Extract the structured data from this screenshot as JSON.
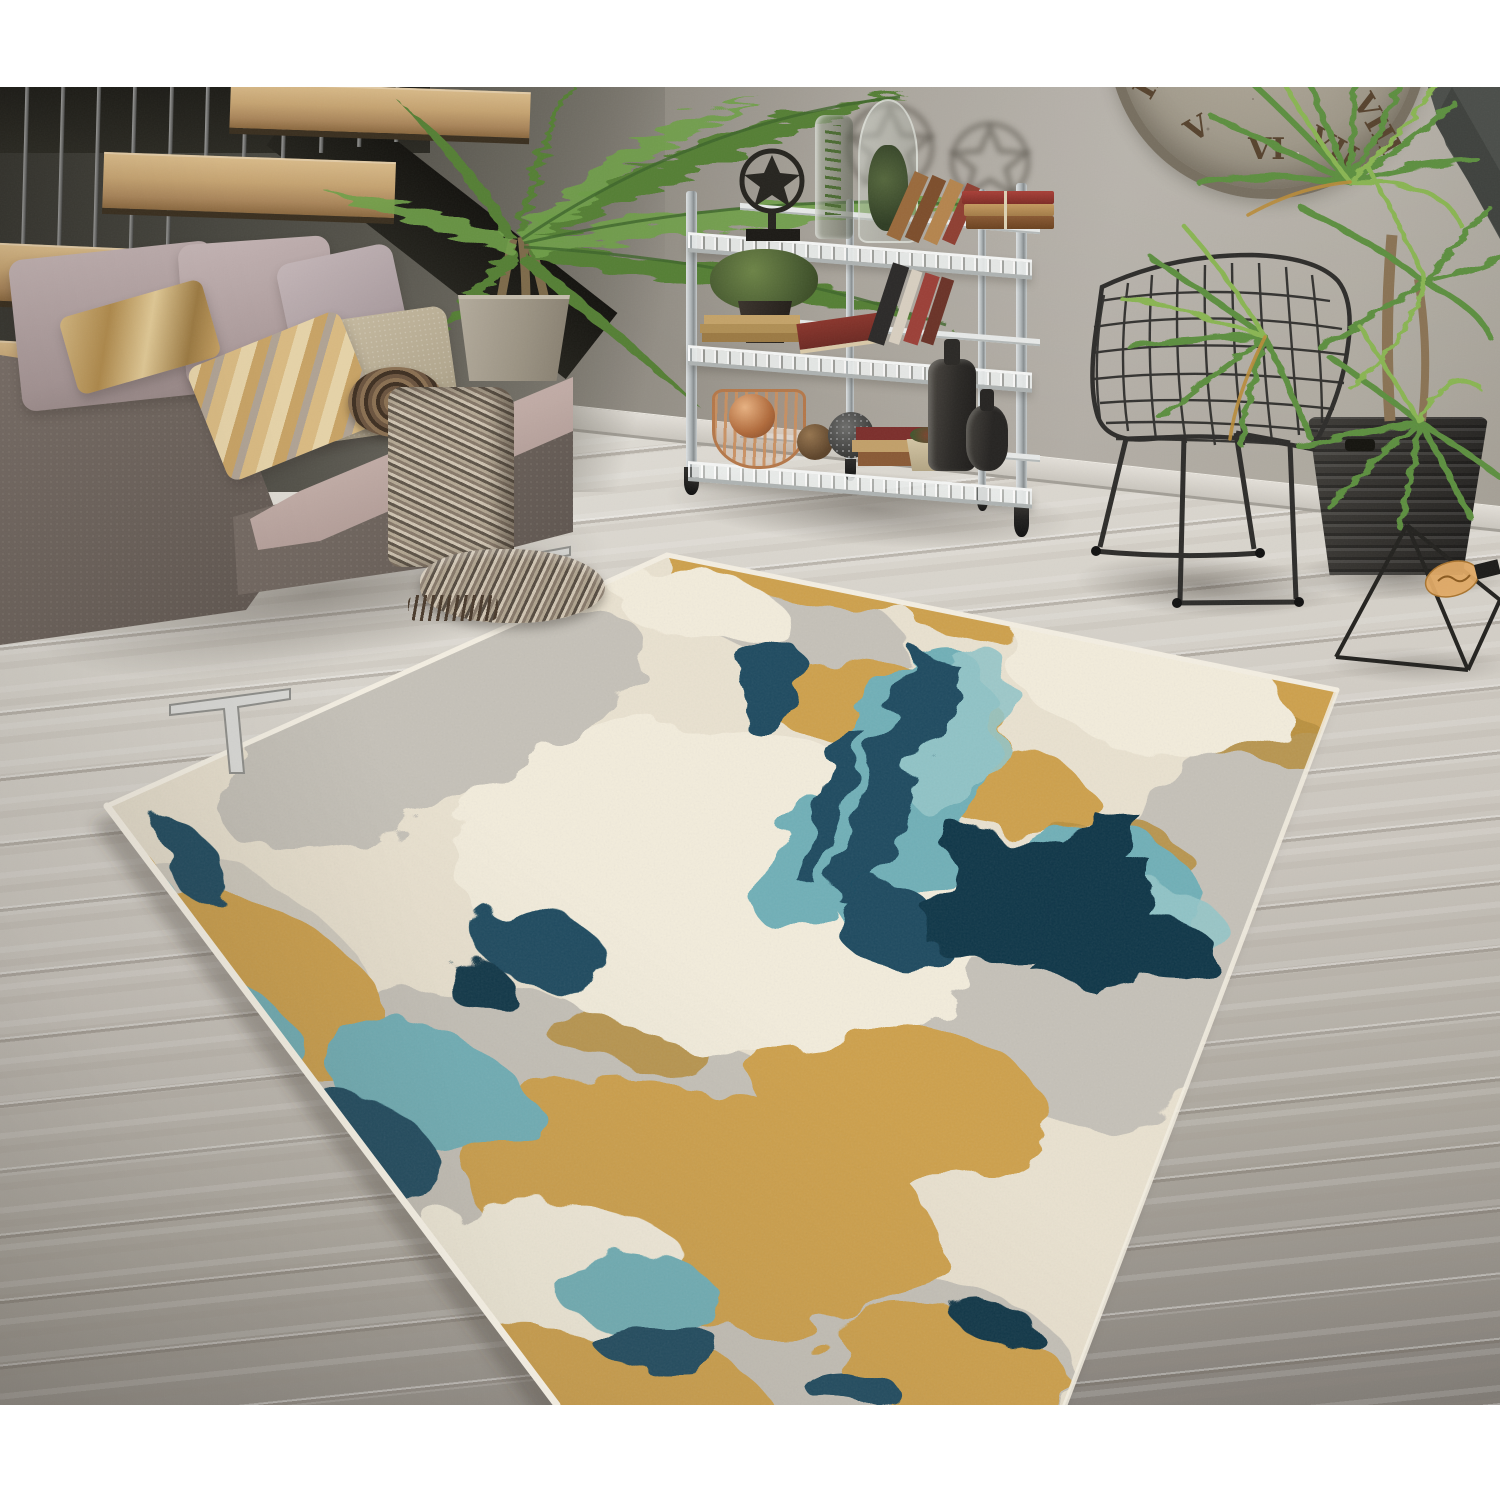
{
  "meta": {
    "image_kind": "lifestyle product photograph",
    "subject": "abstract distressed area rug styled in a modern loft living room",
    "visible_text": "none (only clock Roman numerals)"
  },
  "clock": {
    "numerals": [
      "IIII",
      "V",
      "VI",
      "VII",
      "VIII"
    ]
  },
  "palette": {
    "wall": "#a6a198",
    "wall_dark": "#4a4842",
    "baseboard": "#d9d5ce",
    "floor_light": "#dcd8d1",
    "floor_dark": "#837e78",
    "stair_wood": "#c5a371",
    "stair_metal": "#8c8c8a",
    "stair_beam": "#1a1914",
    "sofa_frame": "#6e645d",
    "sofa_seat": "#c0aba5",
    "pillow_mauve": "#b2a2a2",
    "pillow_lilac": "#b7a9ab",
    "pillow_beige": "#bdb29a",
    "pillow_gold": "#c29d5e",
    "throw": "#8d8274",
    "shelf_metal": "#c3c8c9",
    "copper": "#c08055",
    "book_red": "#9e3b32",
    "book_tan": "#b98e58",
    "book_brown": "#7d4e2c",
    "book_dark": "#2c2a29",
    "palm_green": "#547f36",
    "palm_green_light": "#6fa04a",
    "palm_stem": "#3e662c",
    "palm_trunk": "#7d6a4a",
    "dracaena_green": "#5d8f3f",
    "dracaena_light": "#8ab553",
    "dracaena_dry": "#b98c3a",
    "dracaena_trunk": "#8a7354",
    "chair_black": "#2e2d2b",
    "lamp_black": "#23221f",
    "bulb_amber": "#e0a964",
    "planter_wicker": "#34322e",
    "pot_concrete": "#a49c8d",
    "clock_face": "#a49d8e",
    "clock_numeral": "#57432e",
    "rug": {
      "base": "#ebe3d1",
      "ivory": "#f4eedd",
      "gray": "#c6c2b9",
      "gray_deep": "#b2aea5",
      "gold": "#cfa14b",
      "gold_deep": "#b78e3d",
      "gold_light": "#ddb266",
      "teal": "#6fb0b8",
      "teal_light": "#95c7c9",
      "teal_deep": "#4e96a4",
      "navy": "#1a4a5f",
      "navy_deep": "#0e3447",
      "binding": "#f3eee2"
    }
  },
  "objects": {
    "list": [
      "floating staircase",
      "gray fabric sofa",
      "accent pillows",
      "herringbone throw blanket",
      "kentia palm in concrete pot",
      "chrome wire shelving unit",
      "decorative books and bottles",
      "rustic wall clock",
      "black wire chair",
      "dracaena plant in wicker planter",
      "geometric wire pyramid lamp",
      "abstract area rug",
      "whitewashed wood floor"
    ]
  }
}
